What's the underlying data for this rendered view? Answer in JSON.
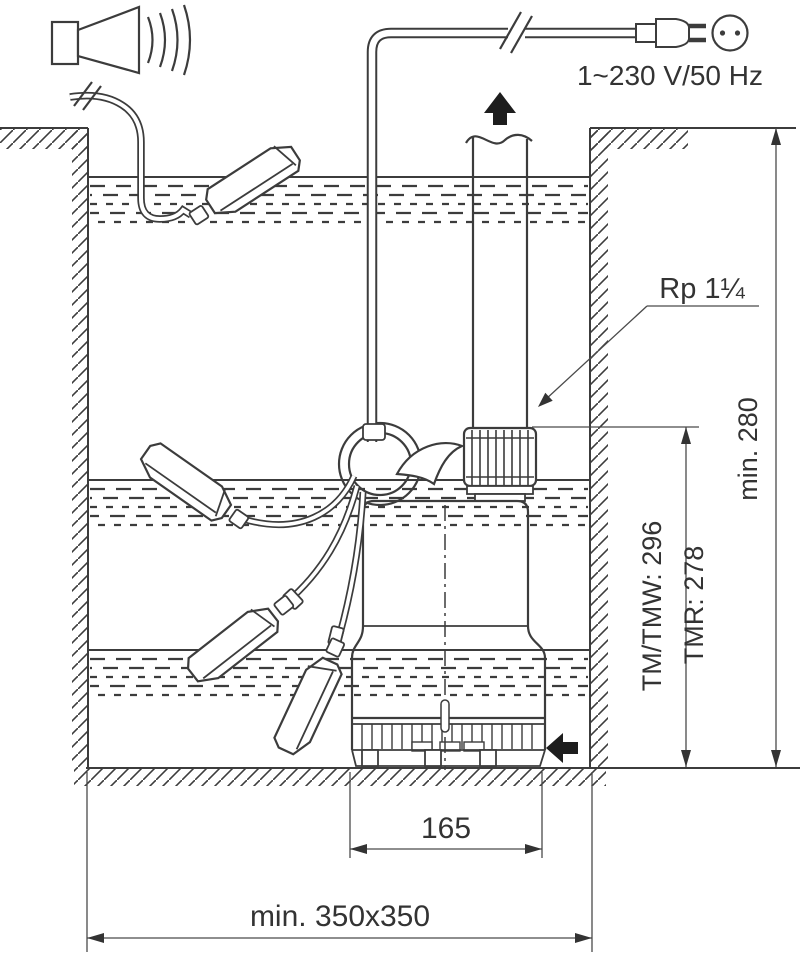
{
  "diagram": {
    "title_hint": "submersible pump pit installation drawing",
    "labels": {
      "power": "1~230 V/50 Hz",
      "thread": "Rp 1¼",
      "pit_depth": "min. 280",
      "height_tm_tmw": "TM/TMW: 296",
      "height_tmr": "TMR: 278",
      "outlet_width": "165",
      "pit_footprint": "min. 350x350"
    },
    "icons": {
      "alarm-horn-icon": "horn with sound waves",
      "cable-break-icon": "double slash cable interruption",
      "power-plug-icon": "mains plug",
      "power-socket-icon": "socket circle with two pins",
      "flow-up-arrow-icon": "black arrow up (discharge)",
      "inflow-arrow-icon": "black arrow left (water inflow)",
      "float-switch": "tilting float switch (4 positions)"
    },
    "colors": {
      "line": "#3c3c3c",
      "dimension": "#4a4a4a",
      "arrow_fill": "#1d1d1d",
      "background": "#ffffff"
    }
  }
}
